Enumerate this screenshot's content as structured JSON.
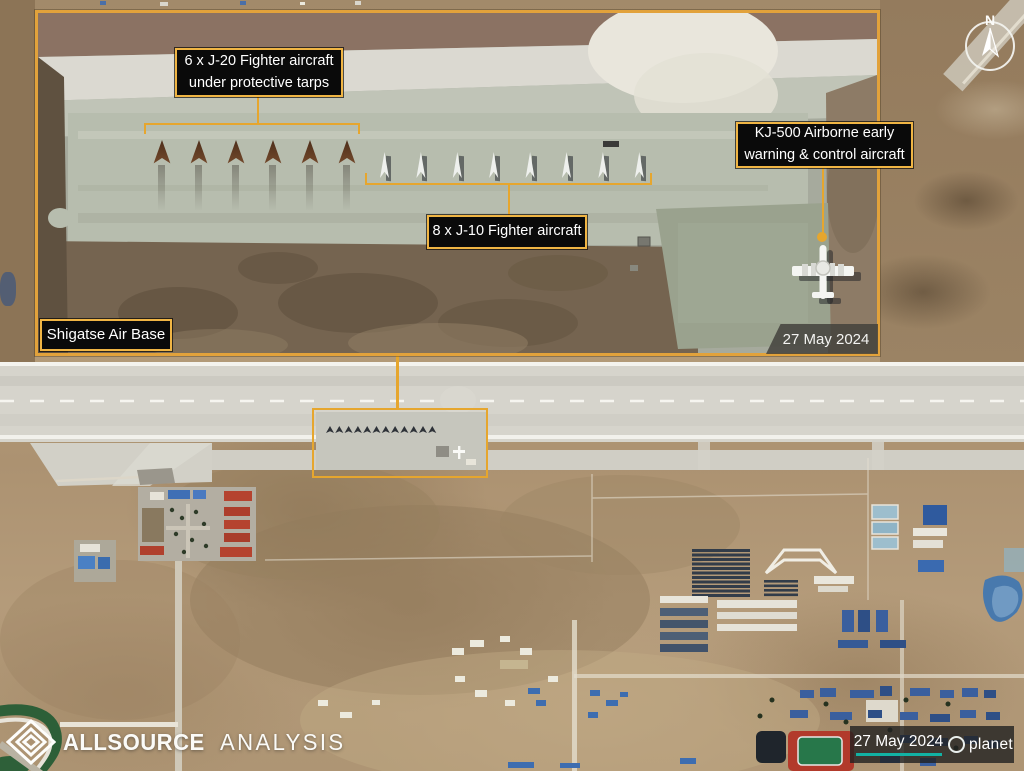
{
  "scene": {
    "description": "Annotated satellite image of an air base"
  },
  "annotation_color": "#e6a62e",
  "inset": {
    "labels": {
      "j20": "6 x J-20 Fighter aircraft under protective tarps",
      "j10": "8 x J-10 Fighter aircraft",
      "kj500": "KJ-500 Airborne early warning & control aircraft",
      "base_name": "Shigatse Air Base",
      "date": "27 May 2024"
    },
    "aircraft": {
      "j20_count": 6,
      "j10_count": 8,
      "kj500_count": 1
    }
  },
  "compass": {
    "north_label": "N"
  },
  "footer": {
    "brand_bold": "ALLSOURCE",
    "brand_light": "ANALYSIS",
    "date": "27 May 2024",
    "provider": "planet",
    "accent_teal": "#12b2a4"
  }
}
